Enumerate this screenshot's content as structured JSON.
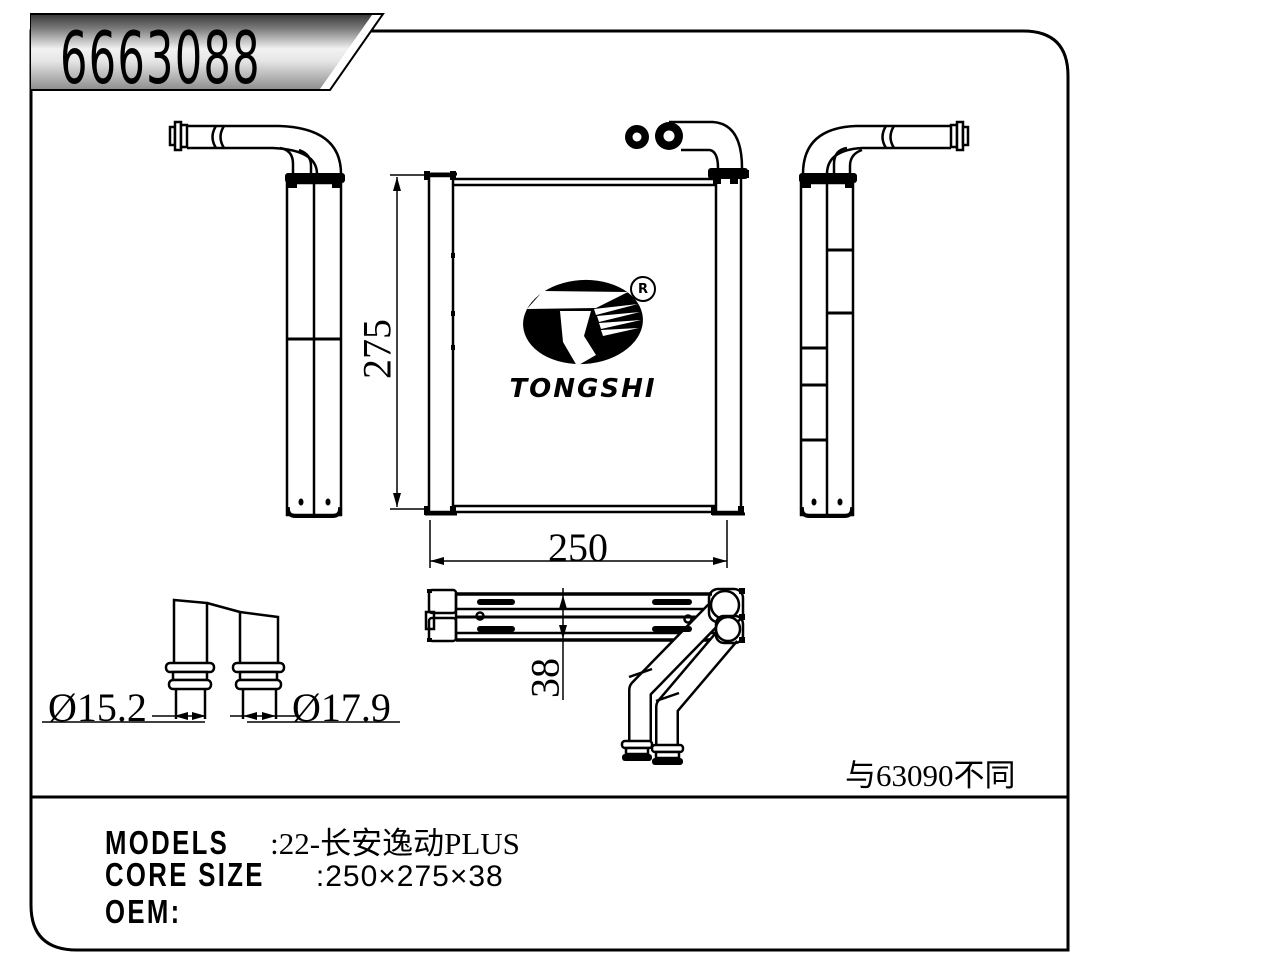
{
  "banner": {
    "part_number": "6663088"
  },
  "logo": {
    "wordmark": "TONGSHI",
    "registered_mark": "R"
  },
  "dimensions": {
    "core_height": "275",
    "core_width": "250",
    "core_depth": "38",
    "pipe_small": "Ø15.2",
    "pipe_large": "Ø17.9"
  },
  "note": "与63090不同",
  "spec_panel": {
    "models_label": "MODELS",
    "models_value": ":22-长安逸动PLUS",
    "core_size_label": "CORE SIZE",
    "core_size_value": ":250×275×38",
    "oem_label": "OEM:"
  },
  "colors": {
    "line": "#000000",
    "background": "#ffffff",
    "banner_dark": "#3c3c3c",
    "banner_light": "#f2f2f2",
    "banner_mid": "#8f8f8f"
  }
}
